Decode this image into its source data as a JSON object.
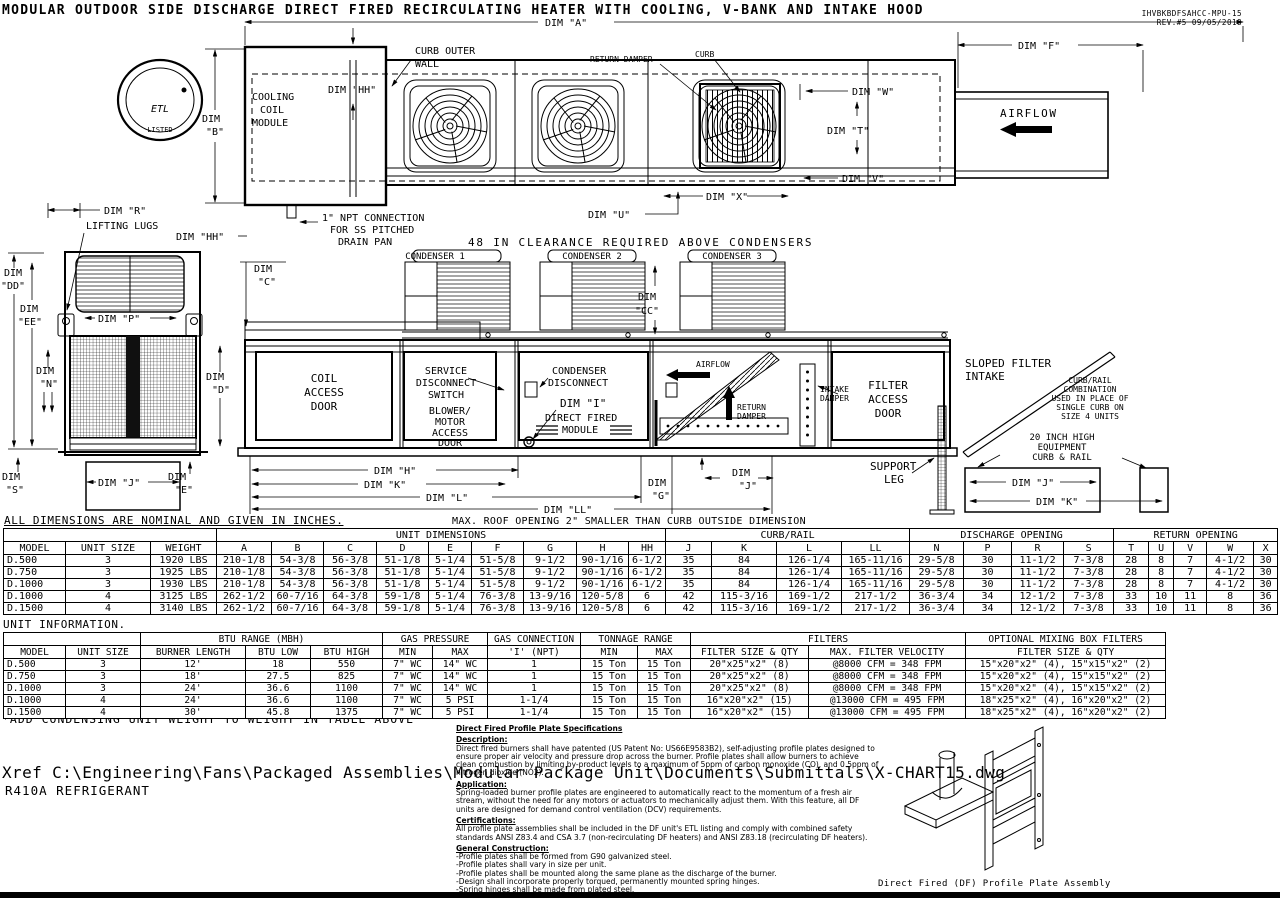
{
  "title": "MODULAR OUTDOOR SIDE DISCHARGE DIRECT FIRED RECIRCULATING HEATER WITH COOLING, V-BANK AND INTAKE HOOD",
  "meta": {
    "doc_number": "IHVBKBDFSAHCC-MPU-15",
    "revision": "REV.#5  09/05/2018"
  },
  "logo": {
    "etl": "ETL",
    "listed": "LISTED"
  },
  "dim": {
    "word": "DIM",
    "a": "DIM \"A\"",
    "b2": "\"B\"",
    "f": "DIM \"F\"",
    "hh": "DIM \"HH\"",
    "w": "DIM \"W\"",
    "t": "DIM \"T\"",
    "v": "DIM \"V\"",
    "x": "DIM \"X\"",
    "u": "DIM \"U\"",
    "r": "DIM \"R\"",
    "p": "DIM \"P\"",
    "dd2": "\"DD\"",
    "ee2": "\"EE\"",
    "n2": "\"N\"",
    "d2": "\"D\"",
    "s2": "\"S\"",
    "e2": "\"E\"",
    "c2": "\"C\"",
    "cc2": "\"CC\"",
    "g2": "\"G\"",
    "j2": "\"J\"",
    "i": "DIM \"I\"",
    "j": "DIM \"J\"",
    "k": "DIM \"K\"",
    "h": "DIM \"H\"",
    "l": "DIM \"L\"",
    "ll": "DIM \"LL\""
  },
  "plan": {
    "cooling_1": "COOLING",
    "cooling_2": "COIL",
    "cooling_3": "MODULE",
    "curb_wall_1": "CURB OUTER",
    "curb_wall_2": "WALL",
    "return_damper": "RETURN DAMPER",
    "curb": "CURB",
    "airflow": "AIRFLOW",
    "npt_1": "1\" NPT CONNECTION",
    "npt_2": "FOR SS PITCHED",
    "npt_3": "DRAIN PAN",
    "clearance": "48 IN CLEARANCE REQUIRED ABOVE CONDENSERS"
  },
  "side": {
    "lifting_lugs": "LIFTING LUGS"
  },
  "elev": {
    "cond1": "CONDENSER 1",
    "cond2": "CONDENSER 2",
    "cond3": "CONDENSER 3",
    "coil_1": "COIL",
    "coil_2": "ACCESS",
    "coil_3": "DOOR",
    "svc_1": "SERVICE",
    "svc_2": "DISCONNECT",
    "svc_3": "SWITCH",
    "blower_1": "BLOWER/",
    "blower_2": "MOTOR",
    "blower_3": "ACCESS",
    "blower_4": "DOOR",
    "cdisc_1": "CONDENSER",
    "cdisc_2": "DISCONNECT",
    "df_1": "DIRECT FIRED",
    "df_2": "MODULE",
    "airflow": "AIRFLOW",
    "return_1": "RETURN",
    "return_2": "DAMPER",
    "intake_1": "INTAKE",
    "intake_2": "DAMPER",
    "filter_1": "FILTER",
    "filter_2": "ACCESS",
    "filter_3": "DOOR",
    "sloped_1": "SLOPED FILTER",
    "sloped_2": "INTAKE",
    "curbrail_1": "CURB/RAIL",
    "curbrail_2": "COMBINATION",
    "curbrail_3": "USED IN PLACE OF",
    "curbrail_4": "SINGLE CURB ON",
    "curbrail_5": "SIZE 4 UNITS",
    "equip_1": "20 INCH HIGH",
    "equip_2": "EQUIPMENT",
    "equip_3": "CURB & RAIL",
    "support_1": "SUPPORT",
    "support_2": "LEG",
    "roof_note": "MAX. ROOF OPENING 2\" SMALLER THAN CURB OUTSIDE DIMENSION"
  },
  "notes": {
    "dims": "ALL DIMENSIONS ARE NOMINAL AND GIVEN IN INCHES.",
    "unit_info": "UNIT INFORMATION.",
    "weight": "*ADD CONDENSING UNIT WEIGHT TO WEIGHT IN TABLE ABOVE"
  },
  "dims_table": {
    "groups": {
      "unit_dimensions": "UNIT DIMENSIONS",
      "curb_rail": "CURB/RAIL",
      "discharge_opening": "DISCHARGE OPENING",
      "return_opening": "RETURN OPENING"
    },
    "columns": [
      "MODEL",
      "UNIT SIZE",
      "WEIGHT",
      "A",
      "B",
      "C",
      "D",
      "E",
      "F",
      "G",
      "H",
      "HH",
      "J",
      "K",
      "L",
      "LL",
      "N",
      "P",
      "R",
      "S",
      "T",
      "U",
      "V",
      "W",
      "X"
    ],
    "rows": [
      [
        "D.500",
        "3",
        "1920 LBS",
        "210-1/8",
        "54-3/8",
        "56-3/8",
        "51-1/8",
        "5-1/4",
        "51-5/8",
        "9-1/2",
        "90-1/16",
        "6-1/2",
        "35",
        "84",
        "126-1/4",
        "165-11/16",
        "29-5/8",
        "30",
        "11-1/2",
        "7-3/8",
        "28",
        "8",
        "7",
        "4-1/2",
        "30"
      ],
      [
        "D.750",
        "3",
        "1925 LBS",
        "210-1/8",
        "54-3/8",
        "56-3/8",
        "51-1/8",
        "5-1/4",
        "51-5/8",
        "9-1/2",
        "90-1/16",
        "6-1/2",
        "35",
        "84",
        "126-1/4",
        "165-11/16",
        "29-5/8",
        "30",
        "11-1/2",
        "7-3/8",
        "28",
        "8",
        "7",
        "4-1/2",
        "30"
      ],
      [
        "D.1000",
        "3",
        "1930 LBS",
        "210-1/8",
        "54-3/8",
        "56-3/8",
        "51-1/8",
        "5-1/4",
        "51-5/8",
        "9-1/2",
        "90-1/16",
        "6-1/2",
        "35",
        "84",
        "126-1/4",
        "165-11/16",
        "29-5/8",
        "30",
        "11-1/2",
        "7-3/8",
        "28",
        "8",
        "7",
        "4-1/2",
        "30"
      ],
      [
        "D.1000",
        "4",
        "3125 LBS",
        "262-1/2",
        "60-7/16",
        "64-3/8",
        "59-1/8",
        "5-1/4",
        "76-3/8",
        "13-9/16",
        "120-5/8",
        "6",
        "42",
        "115-3/16",
        "169-1/2",
        "217-1/2",
        "36-3/4",
        "34",
        "12-1/2",
        "7-3/8",
        "33",
        "10",
        "11",
        "8",
        "36"
      ],
      [
        "D.1500",
        "4",
        "3140 LBS",
        "262-1/2",
        "60-7/16",
        "64-3/8",
        "59-1/8",
        "5-1/4",
        "76-3/8",
        "13-9/16",
        "120-5/8",
        "6",
        "42",
        "115-3/16",
        "169-1/2",
        "217-1/2",
        "36-3/4",
        "34",
        "12-1/2",
        "7-3/8",
        "33",
        "10",
        "11",
        "8",
        "36"
      ]
    ]
  },
  "info_table": {
    "groups": {
      "btu_range": "BTU RANGE (MBH)",
      "gas_pressure": "GAS PRESSURE",
      "gas_connection": "GAS CONNECTION",
      "tonnage_range": "TONNAGE RANGE",
      "filters": "FILTERS",
      "mixing": "OPTIONAL MIXING BOX FILTERS"
    },
    "columns": [
      "MODEL",
      "UNIT SIZE",
      "BURNER LENGTH",
      "BTU LOW",
      "BTU HIGH",
      "MIN",
      "MAX",
      "'I' (NPT)",
      "MIN",
      "MAX",
      "FILTER SIZE & QTY",
      "MAX. FILTER VELOCITY",
      "FILTER SIZE & QTY"
    ],
    "rows": [
      [
        "D.500",
        "3",
        "12'",
        "18",
        "550",
        "7\" WC",
        "14\" WC",
        "1",
        "15 Ton",
        "15 Ton",
        "20\"x25\"x2\" (8)",
        "@8000 CFM = 348 FPM",
        "15\"x20\"x2\" (4), 15\"x15\"x2\" (2)"
      ],
      [
        "D.750",
        "3",
        "18'",
        "27.5",
        "825",
        "7\" WC",
        "14\" WC",
        "1",
        "15 Ton",
        "15 Ton",
        "20\"x25\"x2\" (8)",
        "@8000 CFM = 348 FPM",
        "15\"x20\"x2\" (4), 15\"x15\"x2\" (2)"
      ],
      [
        "D.1000",
        "3",
        "24'",
        "36.6",
        "1100",
        "7\" WC",
        "14\" WC",
        "1",
        "15 Ton",
        "15 Ton",
        "20\"x25\"x2\" (8)",
        "@8000 CFM = 348 FPM",
        "15\"x20\"x2\" (4), 15\"x15\"x2\" (2)"
      ],
      [
        "D.1000",
        "4",
        "24'",
        "36.6",
        "1100",
        "7\" WC",
        "5 PSI",
        "1-1/4",
        "15 Ton",
        "15 Ton",
        "16\"x20\"x2\" (15)",
        "@13000 CFM = 495 FPM",
        "18\"x25\"x2\" (4), 16\"x20\"x2\" (2)"
      ],
      [
        "D.1500",
        "4",
        "30'",
        "45.8",
        "1375",
        "7\" WC",
        "5 PSI",
        "1-1/4",
        "15 Ton",
        "15 Ton",
        "16\"x20\"x2\" (15)",
        "@13000 CFM = 495 FPM",
        "18\"x25\"x2\" (4), 16\"x20\"x2\" (2)"
      ]
    ]
  },
  "spec": {
    "title": "Direct Fired Profile Plate Specifications",
    "desc_label": "Description:",
    "desc": "Direct fired burners shall have patented (US Patent No: US66E9583B2), self-adjusting profile plates designed to ensure proper air velocity and pressure drop across the burner. Profile plates shall allow burners to achieve clean combustion by limiting by-product levels to a maximum of 5ppm of carbon monoxide (CO), and 0.5ppm of nitrogen dioxide (NO2).",
    "app_label": "Application:",
    "app": "Spring-loaded burner profile plates are engineered to automatically react to the momentum of a fresh air stream, without the need for any motors or actuators to mechanically adjust them. With this feature, all DF units are designed for demand control ventilation (DCV) requirements.",
    "cert_label": "Certifications:",
    "cert": "All profile plate assemblies shall be included in the DF unit's ETL listing and comply with combined safety standards ANSI Z83.4 and CSA 3.7 (non-recirculating DF heaters) and ANSI Z83.18 (recirculating DF heaters).",
    "gc_label": "General Construction:",
    "gc_items": [
      "-Profile plates shall be formed from G90 galvanized steel.",
      "-Profile plates shall vary in size per unit.",
      "-Profile plates shall be mounted along the same plane as the discharge of the burner.",
      "-Design shall incorporate properly torqued, permanently mounted spring hinges.",
      "-Spring hinges shall be made from plated steel."
    ]
  },
  "profile_caption": "Direct Fired (DF) Profile Plate Assembly",
  "xref": "Xref C:\\Engineering\\Fans\\Packaged Assemblies\\Modular Package Unit\\Documents\\Submittals\\X-CHART15.dwg",
  "refrigerant": "R410A REFRIGERANT"
}
